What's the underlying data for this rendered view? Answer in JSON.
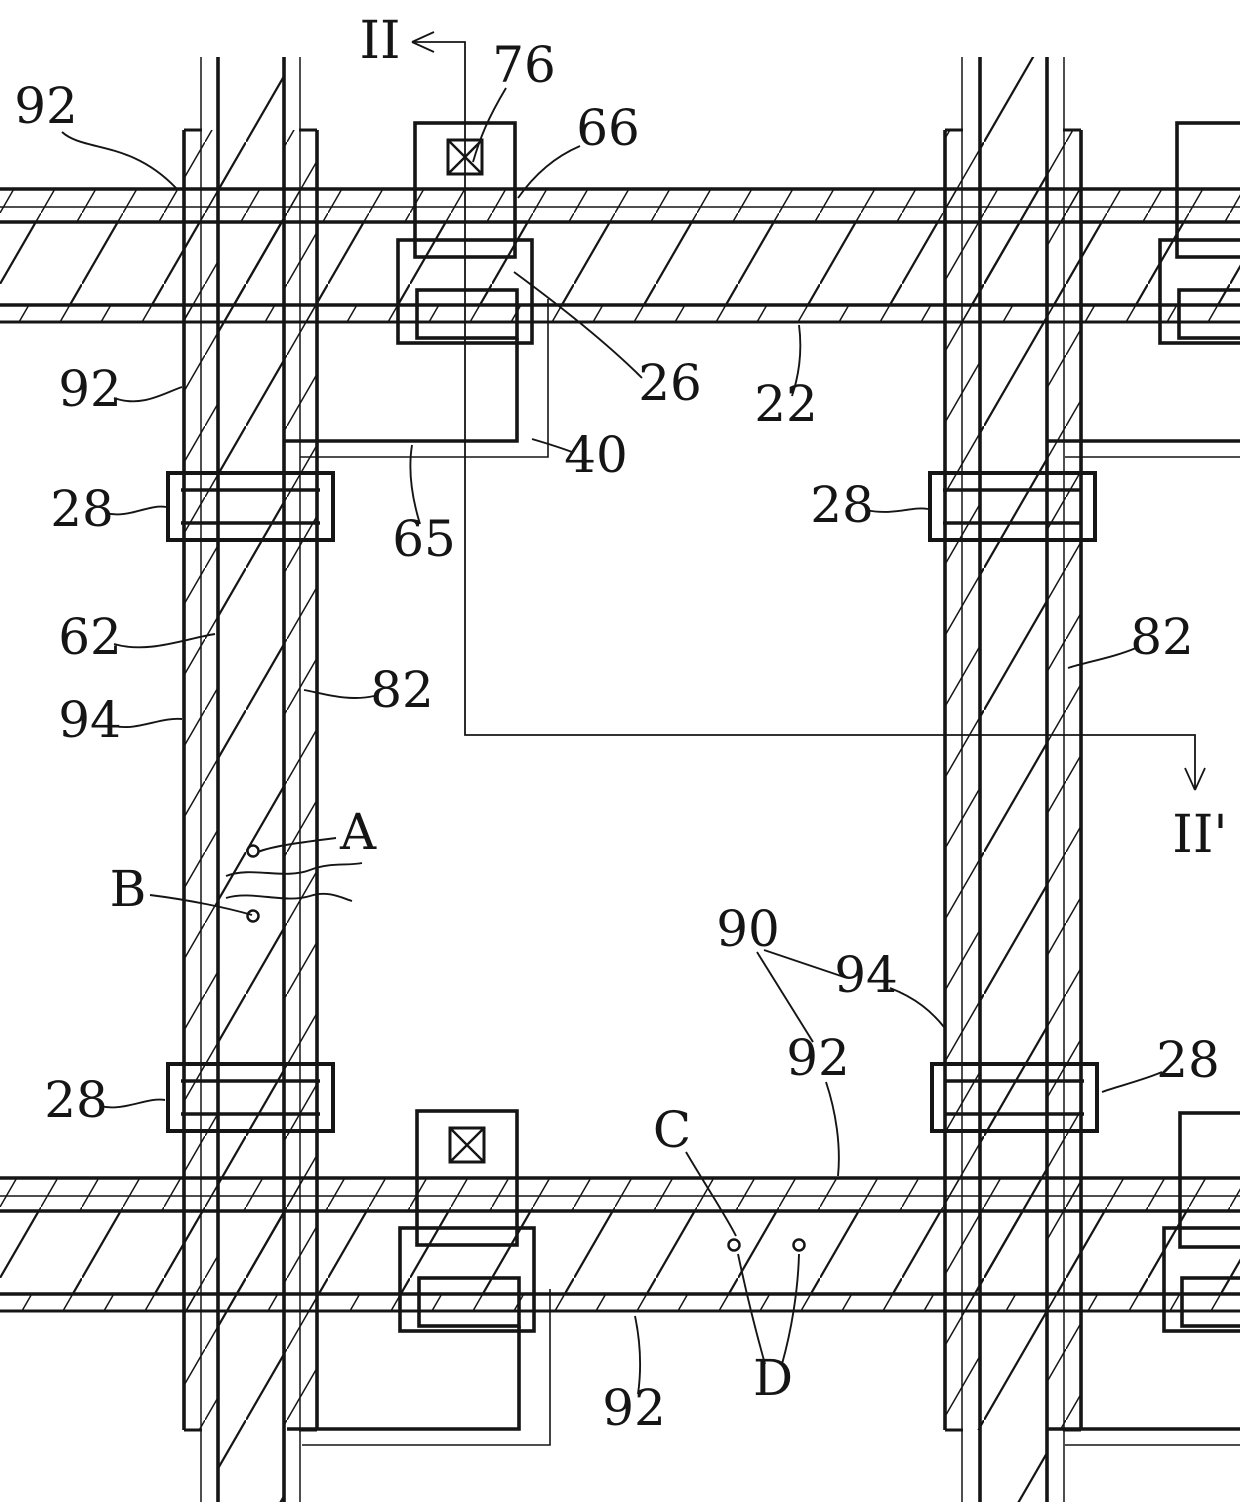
{
  "figure": {
    "colors": {
      "ink": "#151515",
      "paper": "#ffffff"
    },
    "labels": {
      "l92a": "92",
      "lII": "II",
      "l76": "76",
      "l66": "66",
      "l92b": "92",
      "l26": "26",
      "l22": "22",
      "l40": "40",
      "l65": "65",
      "l28a": "28",
      "l28b": "28",
      "l62": "62",
      "l94a": "94",
      "l82a": "82",
      "l82b": "82",
      "lIIp": "II'",
      "lA": "A",
      "lB": "B",
      "l90": "90",
      "l94b": "94",
      "l92c": "92",
      "l28c": "28",
      "l28d": "28",
      "lC": "C",
      "l92d": "92",
      "lD": "D"
    }
  }
}
